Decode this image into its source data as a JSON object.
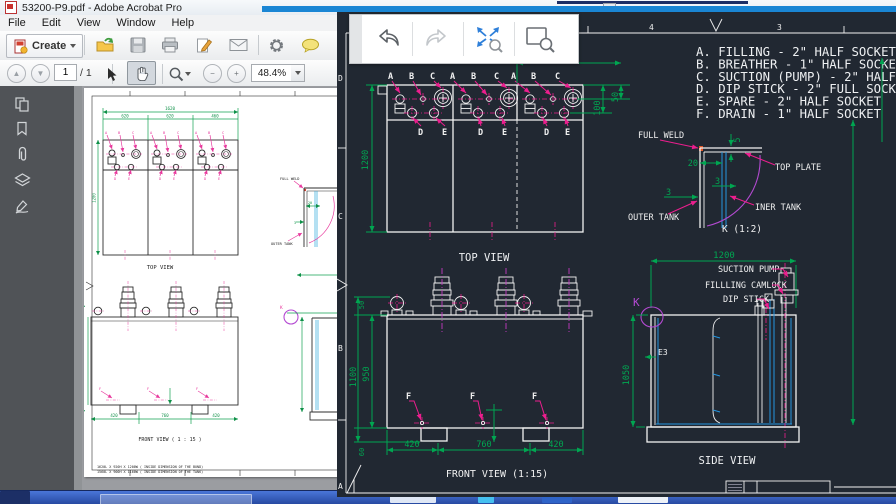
{
  "colors": {
    "accent-blue": "#1a86d4",
    "cad-bg": "#212832",
    "cad-white": "#f2f2f2",
    "dim-green": "#00a651",
    "leader-magenta": "#ec1e8e",
    "center-purple": "#c23ac2",
    "detail-purple": "#b44ad2",
    "cad-blue": "#2596e0",
    "taskbar-blue": "#2f5fc0"
  },
  "acrobat": {
    "title": "53200-P9.pdf - Adobe Acrobat Pro",
    "menu": [
      "File",
      "Edit",
      "View",
      "Window",
      "Help"
    ],
    "toolbar": {
      "create": "Create",
      "page_current": "1",
      "page_total": "/ 1",
      "zoom": "48.4%"
    }
  },
  "pdf": {
    "top_view": "TOP VIEW",
    "front_view": "FRONT VIEW ( 1 : 15 )",
    "notes": [
      "1620L X 920H X 1200W ( INSIDE DIMENSION OF THE BUND)",
      "1560L X 900H X 1160W ( INSIDE DIMENSION OF THE TANK)"
    ],
    "labels": {
      "full_weld": "FULL WELD",
      "outer_tank": "OUTER TANK",
      "k": "K"
    },
    "dims": {
      "total": "1620",
      "seg1": "620",
      "seg2": "620",
      "seg3": "460",
      "height": "1200",
      "b1": "420",
      "b2": "760",
      "b3": "420",
      "d20": "20",
      "d3": "3"
    },
    "ports": {
      "a": "A",
      "b": "B",
      "c": "C",
      "d": "D",
      "e": "E",
      "f": "F"
    }
  },
  "cad": {
    "legend": [
      "A. FILLING - 2\" HALF SOCKET",
      "B. BREATHER - 1\" HALF SOCKET",
      "C. SUCTION (PUMP) - 2\" HALF SOCKET",
      "D. DIP STICK - 2\" FULL SOCKET",
      "E. SPARE - 2\" HALF SOCKET",
      "F. DRAIN - 1\" HALF SOCKET"
    ],
    "views": {
      "top": "TOP VIEW",
      "front": "FRONT VIEW (1:15)",
      "side": "SIDE VIEW",
      "detail": "K (1:2)"
    },
    "labels": {
      "full_weld": "FULL WELD",
      "top_plate": "TOP PLATE",
      "inner_tank": "INER TANK",
      "outer_tank": "OUTER TANK",
      "suction_pump": "SUCTION PUMP",
      "filling_camlock": "FILLLING CAMLOCK",
      "dip_stick": "DIP STICK",
      "e3": "E3",
      "k": "K"
    },
    "dims": {
      "d460": "460",
      "top_h": "1200",
      "d50": "50",
      "d100": "100",
      "d20": "20",
      "d3a": "3",
      "d3b": "3",
      "d5": "5",
      "side_w": "1200",
      "side_h": "1050",
      "f1": "420",
      "f2": "760",
      "f3": "420",
      "front_h1": "1100",
      "front_h2": "950",
      "front_t": "50",
      "front_b": "60"
    },
    "ports": {
      "a": "A",
      "b": "B",
      "c": "C",
      "d": "D",
      "e": "E",
      "f": "F"
    },
    "zones": {
      "n5": "5",
      "n4": "4",
      "n3": "3",
      "zd": "D",
      "zc": "C",
      "zb": "B",
      "za": "A"
    }
  }
}
